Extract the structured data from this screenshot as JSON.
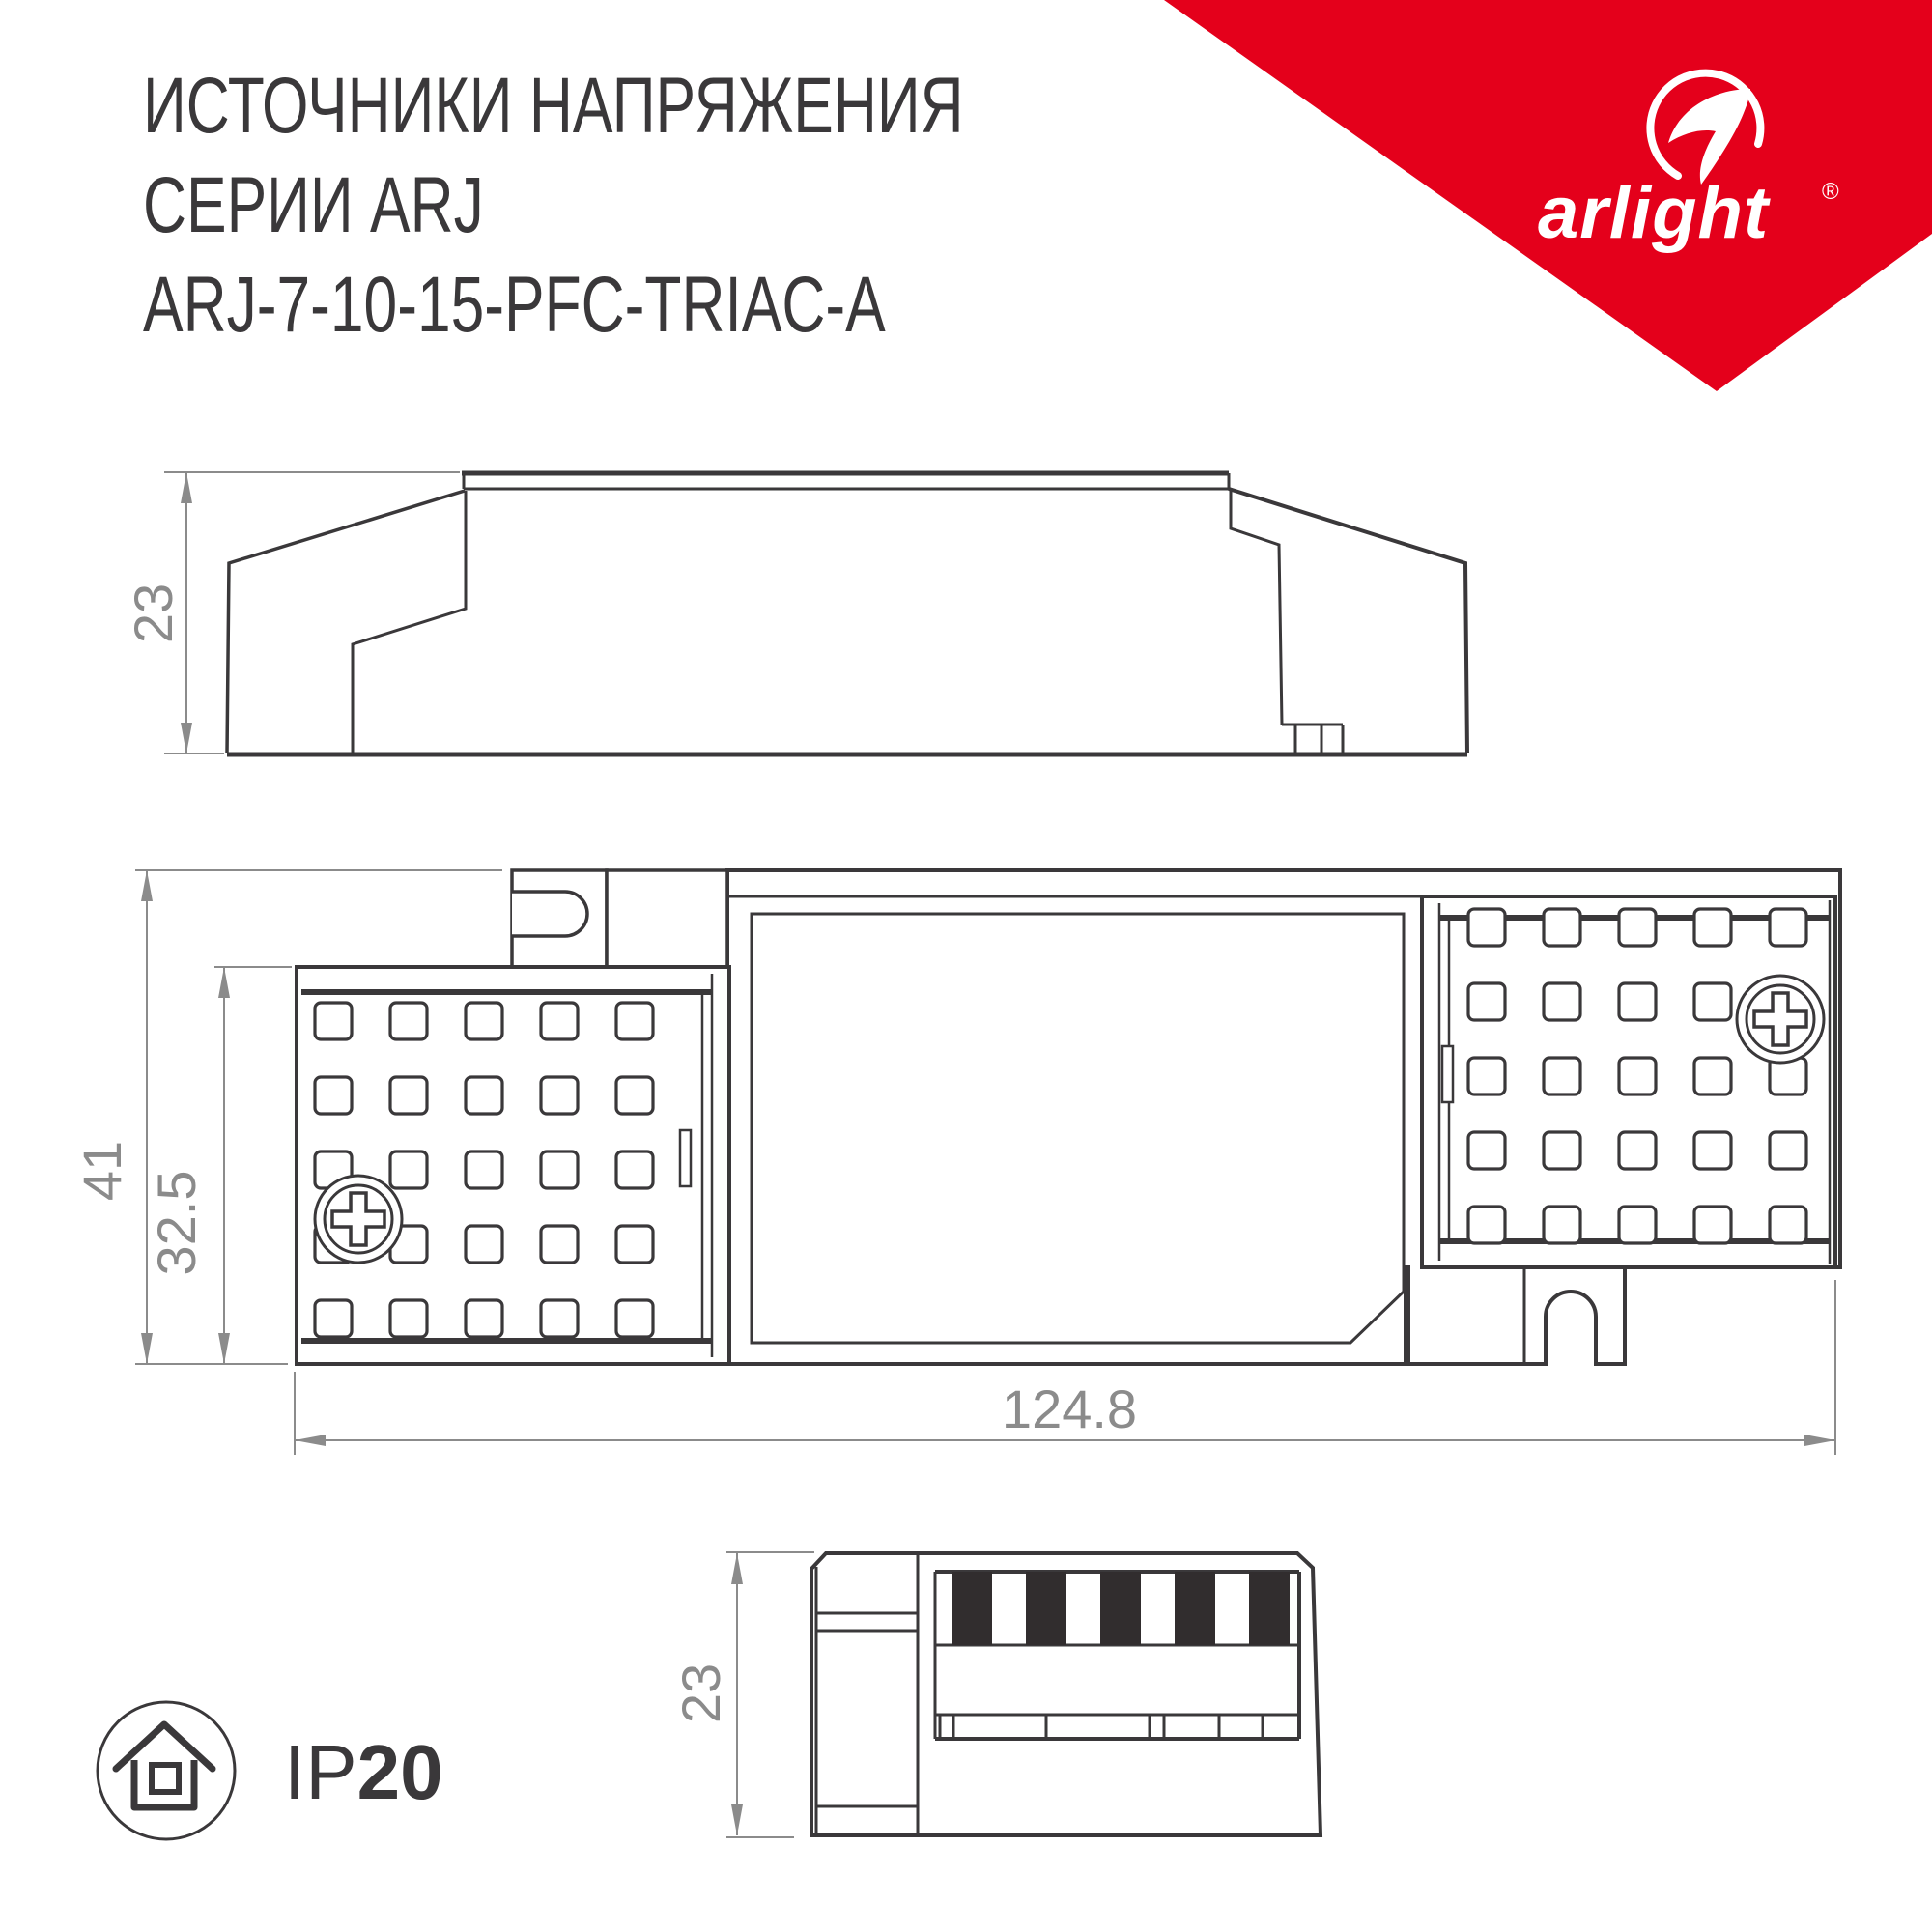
{
  "title": {
    "line1": "ИСТОЧНИКИ НАПРЯЖЕНИЯ",
    "line2": "СЕРИИ ARJ",
    "line3": "ARJ-7-10-15-PFC-TRIAC-A"
  },
  "logo": {
    "brand": "arlight",
    "registered": "®"
  },
  "views": {
    "side": {
      "label": "side-view",
      "height": "23"
    },
    "top": {
      "label": "top-view",
      "height": "41",
      "terminal_cover_height": "32.5",
      "length": "124.8"
    },
    "end": {
      "label": "end-view",
      "height": "23"
    }
  },
  "ip_rating": {
    "prefix": "IP",
    "value": "20"
  },
  "colors": {
    "ink": "#3a383a",
    "dimension_gray": "#8b8b8b",
    "brand_red": "#e4001b",
    "terminal_slot": "#312d2e",
    "background": "#ffffff"
  },
  "icons": {
    "logo": "arlight-swoosh-icon",
    "ip": "house-in-circle-icon",
    "screws": "phillips-screw-icon",
    "mounting": "u-slot-mounting-tab"
  }
}
